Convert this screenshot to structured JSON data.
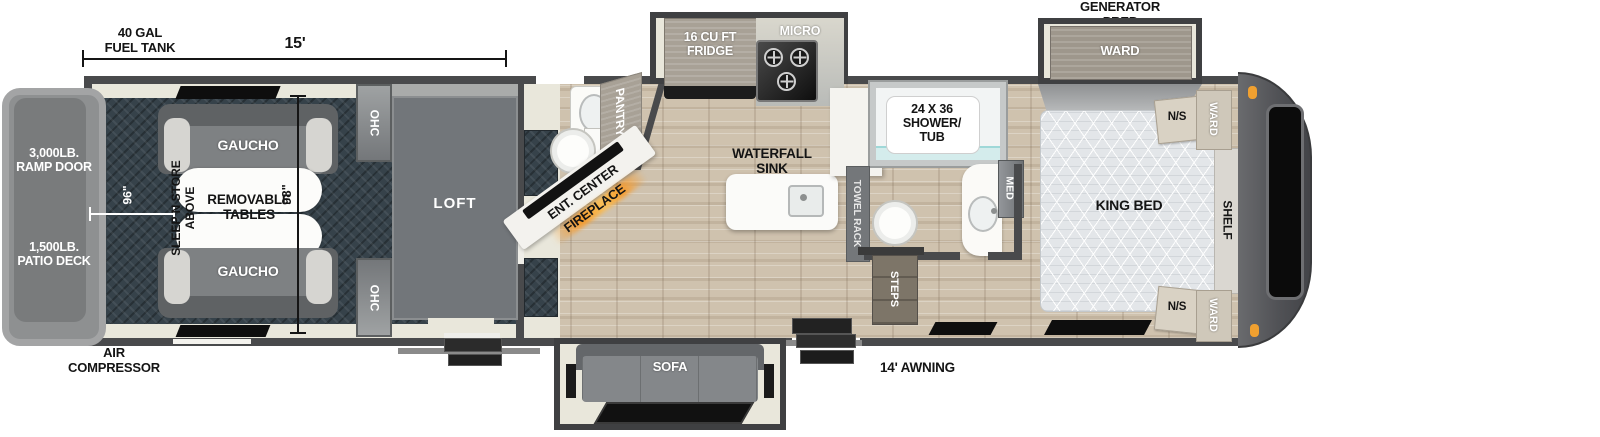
{
  "exterior": {
    "fuel_tank_l1": "40 GAL",
    "fuel_tank_l2": "FUEL TANK",
    "dim_15ft": "15'",
    "generator_prep_l1": "GENERATOR",
    "generator_prep_l2": "PREP",
    "ramp_l1": "3,000LB.",
    "ramp_l2": "RAMP DOOR",
    "patio_l1": "1,500LB.",
    "patio_l2": "PATIO DECK",
    "dim_96": "96\"",
    "dim_98": "98\"",
    "air_l1": "AIR",
    "air_l2": "COMPRESSOR",
    "awning": "14' AWNING"
  },
  "garage": {
    "gaucho_top": "GAUCHO",
    "gaucho_bottom": "GAUCHO",
    "tables_l1": "REMOVABLE",
    "tables_l2": "TABLES",
    "sleep_l1": "SLEEP N STORE",
    "sleep_l2": "ABOVE",
    "ohc_top": "OHC",
    "ohc_bottom": "OHC",
    "loft": "LOFT"
  },
  "living": {
    "ent_center": "ENT. CENTER",
    "fireplace": "FIREPLACE",
    "pantry": "PANTRY",
    "sofa": "SOFA"
  },
  "kitchen": {
    "fridge_l1": "16 CU FT",
    "fridge_l2": "FRIDGE",
    "micro": "MICRO",
    "sink_l1": "WATERFALL",
    "sink_l2": "SINK"
  },
  "bathroom": {
    "shower_l1": "24 X 36",
    "shower_l2": "SHOWER/",
    "shower_l3": "TUB",
    "towel_rack": "TOWEL RACK",
    "med": "MED",
    "steps": "STEPS"
  },
  "bedroom": {
    "ward_slide": "WARD",
    "king_bed": "KING BED",
    "shelf": "SHELF",
    "ns_top": "N/S",
    "ns_bottom": "N/S",
    "ward_top": "WARD",
    "ward_bottom": "WARD"
  },
  "colors": {
    "wall": "#494a4c",
    "wood_floor": "#cfc2ae",
    "garage_floor": "#36424a",
    "cream": "#e9e7db",
    "fireplace_glow": "#f59b2d",
    "marker_light": "#f0a030"
  }
}
